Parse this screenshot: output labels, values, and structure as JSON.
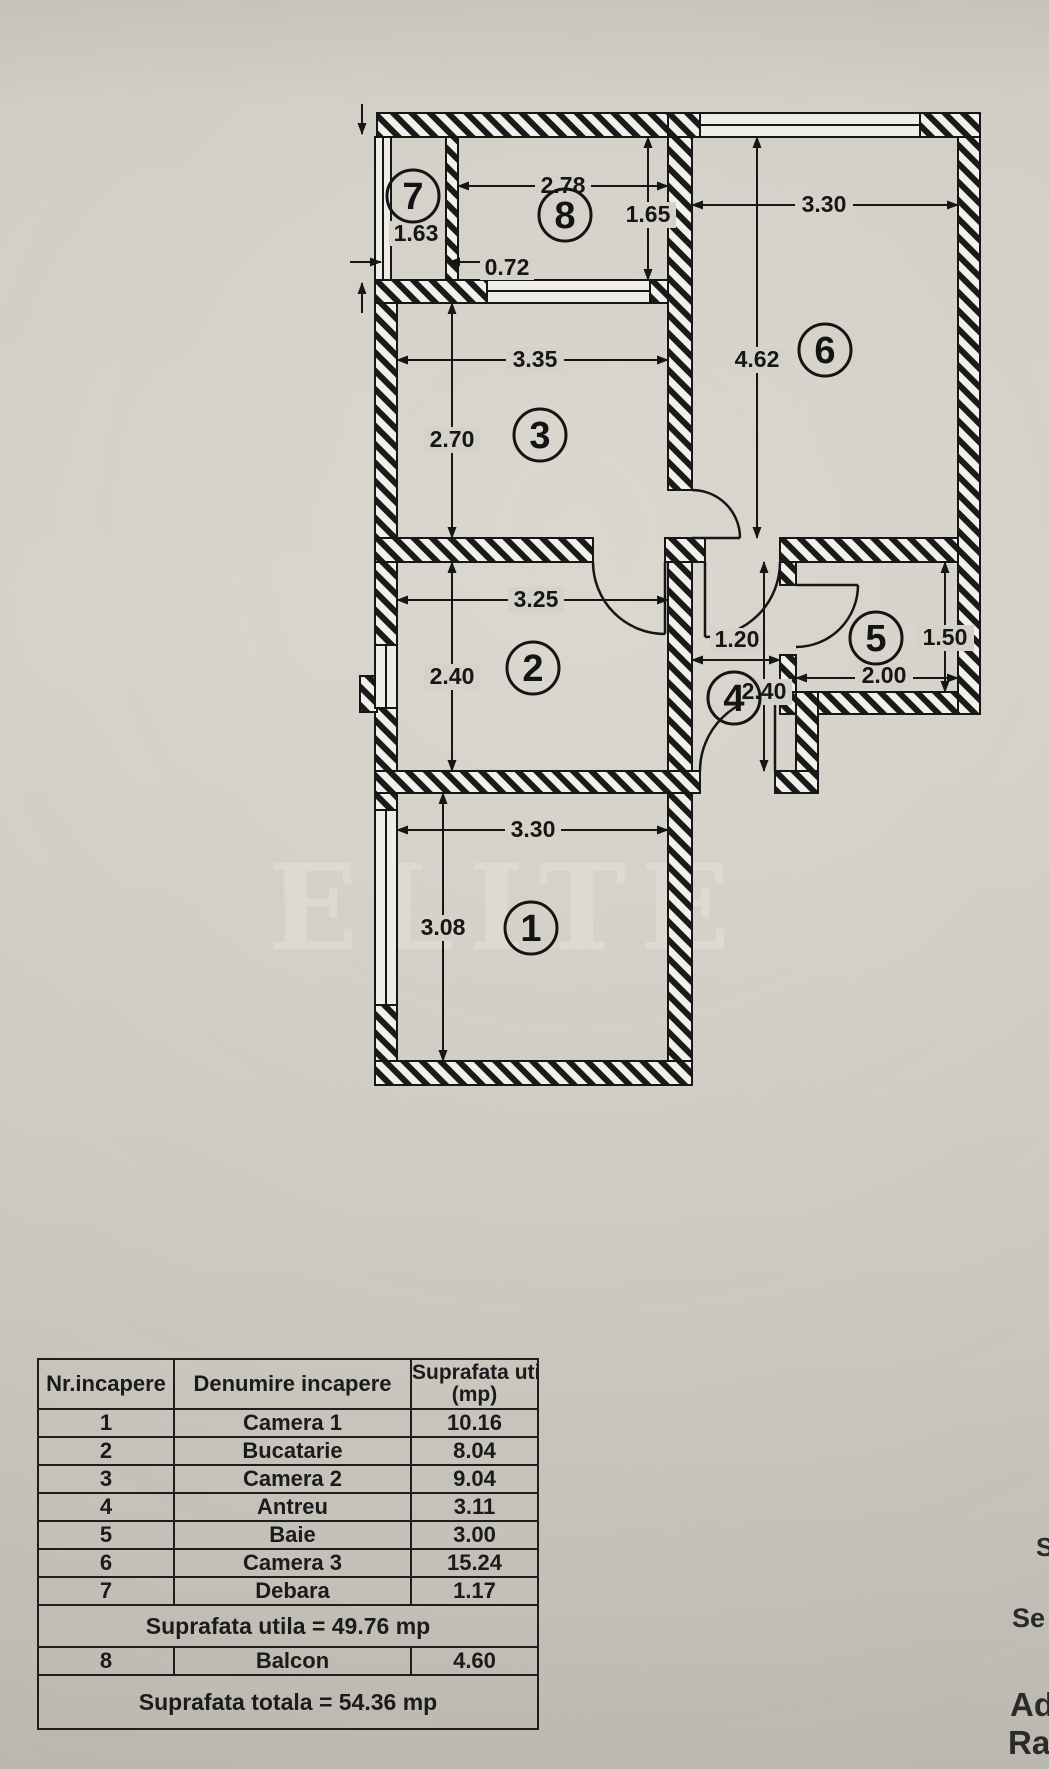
{
  "plan": {
    "watermark": "ELITE",
    "rooms": {
      "r1": {
        "num": "1",
        "width": "3.30",
        "height": "3.08"
      },
      "r2": {
        "num": "2",
        "width": "3.25",
        "height": "2.40"
      },
      "r3": {
        "num": "3",
        "width": "3.35",
        "height": "2.70"
      },
      "r4": {
        "num": "4",
        "width": "1.20",
        "height": "2.40"
      },
      "r5": {
        "num": "5",
        "width": "2.00",
        "height": "1.50"
      },
      "r6": {
        "num": "6",
        "width": "3.30",
        "height": "4.62"
      },
      "r7": {
        "num": "7",
        "width": "0.72",
        "height": "1.63"
      },
      "r8": {
        "num": "8",
        "width": "2.78",
        "height": "1.65"
      }
    }
  },
  "table": {
    "headers": [
      "Nr.incapere",
      "Denumire incapere",
      "Suprafata utila",
      "(mp)"
    ],
    "rows": [
      [
        "1",
        "Camera 1",
        "10.16"
      ],
      [
        "2",
        "Bucatarie",
        "8.04"
      ],
      [
        "3",
        "Camera 2",
        "9.04"
      ],
      [
        "4",
        "Antreu",
        "3.11"
      ],
      [
        "5",
        "Baie",
        "3.00"
      ],
      [
        "6",
        "Camera 3",
        "15.24"
      ],
      [
        "7",
        "Debara",
        "1.17"
      ]
    ],
    "subtotal": "Suprafata utila = 49.76 mp",
    "balcony_row": [
      "8",
      "Balcon",
      "4.60"
    ],
    "total": "Suprafata totala = 54.36 mp"
  },
  "edge_text": {
    "s": "S",
    "se": "Se",
    "ad": "Ad",
    "rac": "Rac"
  }
}
